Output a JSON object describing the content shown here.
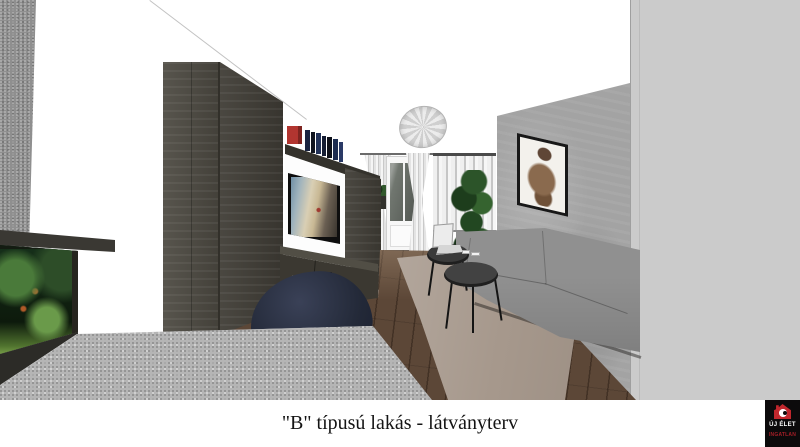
{
  "image": {
    "type": "3d-interior-render",
    "subject": "living room visualization of a type B apartment"
  },
  "caption": {
    "text": "\"B\" típusú lakás - látványterv"
  },
  "logo": {
    "title": "ÚJ ÉLET",
    "subtitle": "INGATLAN",
    "background": "#0c0a0b",
    "accent_red": "#c1272d"
  },
  "palette": {
    "wall_white": "#ffffff",
    "concrete_gray": "#a3a3a3",
    "side_wall_gray": "#cbcbcb",
    "wardrobe_dark_wood": "#4d4a42",
    "floor_wood": "#5c4737",
    "rug_taupe": "#a6988c",
    "sofa_gray": "#878787",
    "accent_red_box": "#b23530",
    "plant_green": "#2b5328",
    "caption_text": "#141414"
  },
  "objects": [
    "ceiling lamp",
    "dark wood wardrobe",
    "media wall with TV",
    "floating shelf with books and red box",
    "TV cabinet with drawers",
    "built-in aquarium",
    "balcony door with tied curtains",
    "window with vertical blinds",
    "window flower box",
    "tall potted plant",
    "gray sofa",
    "nesting coffee tables",
    "laptop",
    "area rug",
    "framed wall picture",
    "concrete accent wall",
    "granite counter",
    "navy bean bag"
  ]
}
